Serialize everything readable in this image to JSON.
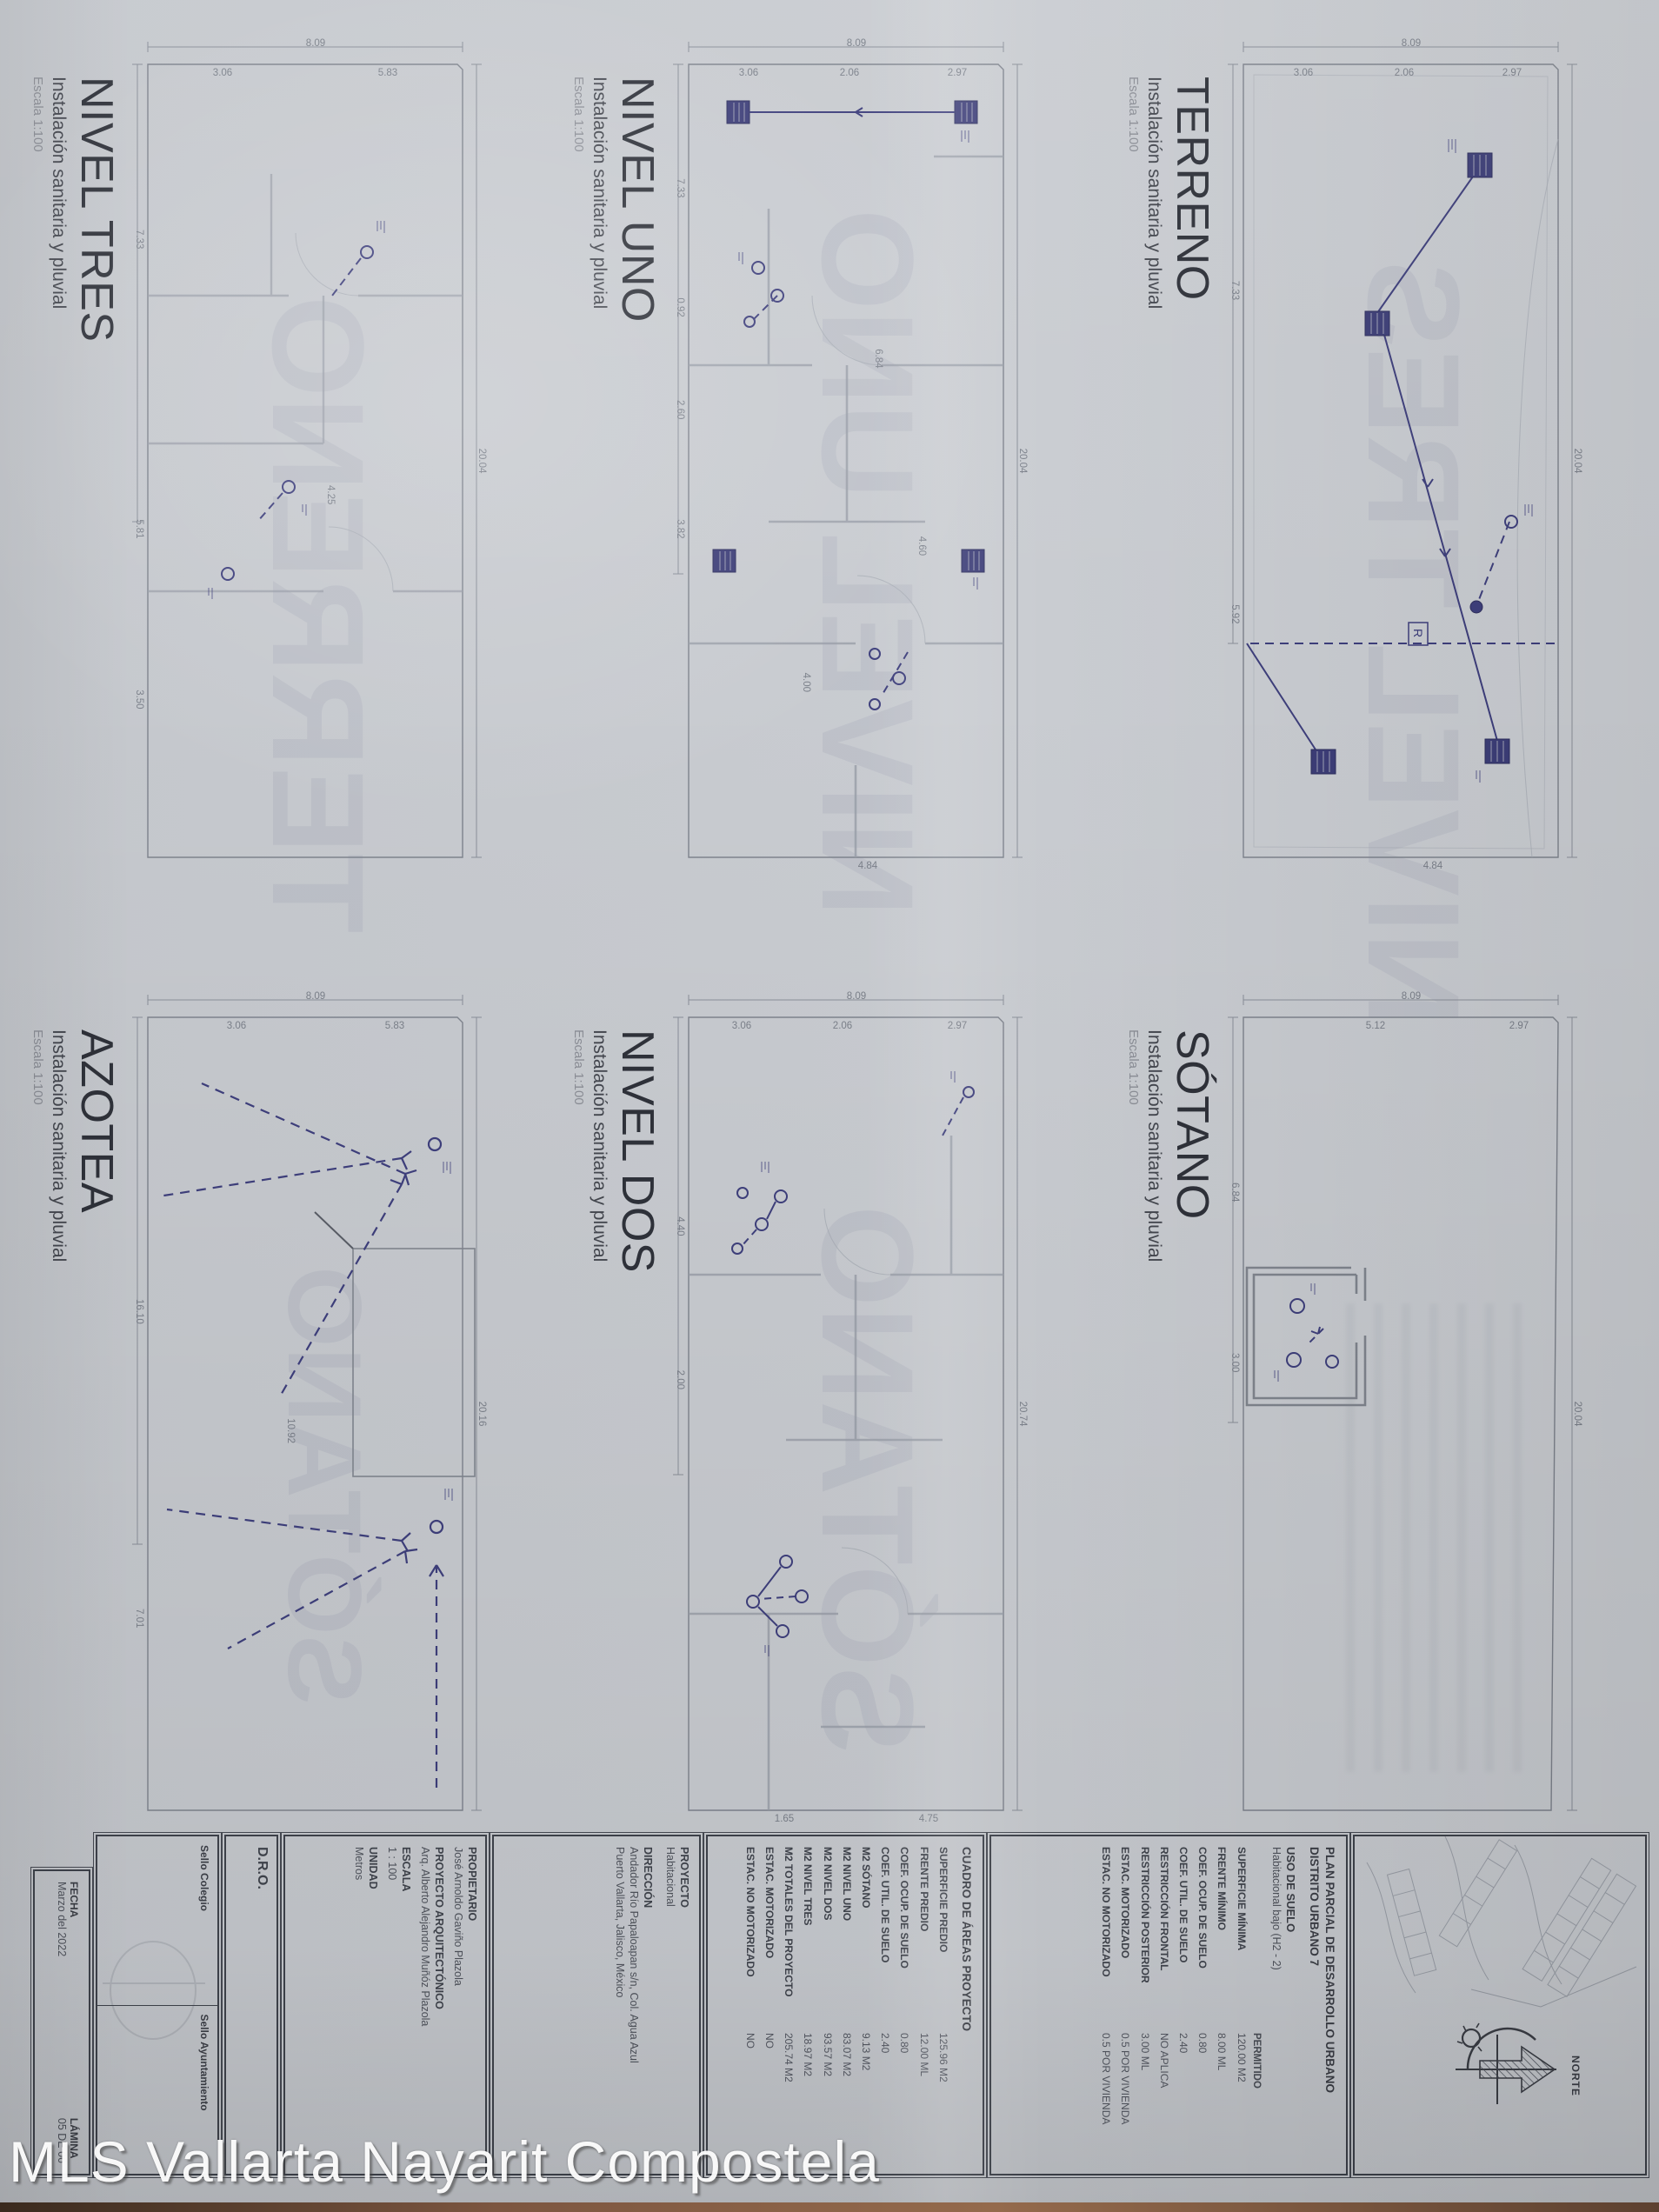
{
  "watermark": {
    "text": "MLS Vallarta Nayarit Compostela"
  },
  "panels": [
    {
      "title": "TERRENO",
      "subtitle": "Instalación sanitaria y pluvial",
      "scale": "Escala 1:100",
      "ghost": "NIVEL TRES",
      "r_label": "R",
      "dims": [
        {
          "t": "8.09",
          "x": 1,
          "y": 48,
          "v": 1
        },
        {
          "t": "2.97",
          "x": 4.5,
          "y": 20,
          "v": 1
        },
        {
          "t": "2.06",
          "x": 4.5,
          "y": 50,
          "v": 1
        },
        {
          "t": "3.06",
          "x": 4.5,
          "y": 78,
          "v": 1
        },
        {
          "t": "20.04",
          "x": 50,
          "y": 2
        },
        {
          "t": "7.33",
          "x": 30,
          "y": 97
        },
        {
          "t": "5.92",
          "x": 68,
          "y": 97
        },
        {
          "t": "4.84",
          "x": 97.5,
          "y": 42,
          "v": 1
        }
      ]
    },
    {
      "title": "NIVEL UNO",
      "subtitle": "Instalación sanitaria y pluvial",
      "scale": "Escala 1:100",
      "ghost": "NIVEL UNO",
      "dims": [
        {
          "t": "8.09",
          "x": 1,
          "y": 48,
          "v": 1
        },
        {
          "t": "2.97",
          "x": 4.5,
          "y": 20,
          "v": 1
        },
        {
          "t": "2.06",
          "x": 4.5,
          "y": 50,
          "v": 1
        },
        {
          "t": "3.06",
          "x": 4.5,
          "y": 78,
          "v": 1
        },
        {
          "t": "20.04",
          "x": 50,
          "y": 2
        },
        {
          "t": "7.33",
          "x": 18,
          "y": 97
        },
        {
          "t": "0.92",
          "x": 32,
          "y": 97
        },
        {
          "t": "2.60",
          "x": 44,
          "y": 97
        },
        {
          "t": "3.82",
          "x": 58,
          "y": 97
        },
        {
          "t": "4.84",
          "x": 97.5,
          "y": 45,
          "v": 1
        },
        {
          "t": "6.84",
          "x": 38,
          "y": 42
        },
        {
          "t": "4.60",
          "x": 60,
          "y": 30
        },
        {
          "t": "4.00",
          "x": 76,
          "y": 62
        }
      ]
    },
    {
      "title": "NIVEL TRES",
      "subtitle": "Instalación sanitaria y pluvial",
      "scale": "Escala 1:100",
      "ghost": "TERRENO",
      "dims": [
        {
          "t": "8.09",
          "x": 1,
          "y": 48,
          "v": 1
        },
        {
          "t": "5.83",
          "x": 4.5,
          "y": 28,
          "v": 1
        },
        {
          "t": "3.06",
          "x": 4.5,
          "y": 74,
          "v": 1
        },
        {
          "t": "20.04",
          "x": 50,
          "y": 2
        },
        {
          "t": "7.33",
          "x": 24,
          "y": 97
        },
        {
          "t": "5.81",
          "x": 58,
          "y": 97
        },
        {
          "t": "3.50",
          "x": 78,
          "y": 97
        },
        {
          "t": "4.25",
          "x": 54,
          "y": 44
        }
      ]
    },
    {
      "title": "SÓTANO",
      "subtitle": "Instalación sanitaria y pluvial",
      "scale": "Escala 1:100",
      "ghost": "",
      "dims": [
        {
          "t": "8.09",
          "x": 1,
          "y": 48,
          "v": 1
        },
        {
          "t": "2.97",
          "x": 4.5,
          "y": 18,
          "v": 1
        },
        {
          "t": "5.12",
          "x": 4.5,
          "y": 58,
          "v": 1
        },
        {
          "t": "20.04",
          "x": 50,
          "y": 2
        },
        {
          "t": "6.84",
          "x": 24,
          "y": 97
        },
        {
          "t": "3.00",
          "x": 44,
          "y": 97
        }
      ]
    },
    {
      "title": "NIVEL DOS",
      "subtitle": "Instalación sanitaria y pluvial",
      "scale": "Escala 1:100",
      "ghost": "SÓTANO",
      "dims": [
        {
          "t": "8.09",
          "x": 1,
          "y": 48,
          "v": 1
        },
        {
          "t": "2.97",
          "x": 4.5,
          "y": 20,
          "v": 1
        },
        {
          "t": "2.06",
          "x": 4.5,
          "y": 52,
          "v": 1
        },
        {
          "t": "3.06",
          "x": 4.5,
          "y": 80,
          "v": 1
        },
        {
          "t": "20.74",
          "x": 50,
          "y": 2
        },
        {
          "t": "4.40",
          "x": 28,
          "y": 97
        },
        {
          "t": "2.00",
          "x": 46,
          "y": 97
        },
        {
          "t": "4.75",
          "x": 97.5,
          "y": 28,
          "v": 1
        },
        {
          "t": "1.65",
          "x": 97.5,
          "y": 68,
          "v": 1
        }
      ]
    },
    {
      "title": "AZOTEA",
      "subtitle": "Instalación sanitaria y pluvial",
      "scale": "Escala 1:100",
      "ghost": "SÓTANO",
      "dims": [
        {
          "t": "8.09",
          "x": 1,
          "y": 48,
          "v": 1
        },
        {
          "t": "5.83",
          "x": 4.5,
          "y": 26,
          "v": 1
        },
        {
          "t": "3.06",
          "x": 4.5,
          "y": 70,
          "v": 1
        },
        {
          "t": "20.16",
          "x": 50,
          "y": 2
        },
        {
          "t": "16.10",
          "x": 38,
          "y": 97
        },
        {
          "t": "7.01",
          "x": 74,
          "y": 97
        },
        {
          "t": "10.92",
          "x": 52,
          "y": 55
        }
      ]
    }
  ],
  "titleblock": {
    "norte_label": "NORTE",
    "plan_parcial": {
      "title_l1": "PLAN PARCIAL DE DESARROLLO URBANO",
      "title_l2": "DISTRITO URBANO 7",
      "uso_header": "USO DE SUELO",
      "uso_value": "Habitacional bajo (H2 - 2)",
      "col_header": "PERMITIDO",
      "rows": [
        [
          "SUPERFICIE MÍNIMA",
          "120.00 M2"
        ],
        [
          "FRENTE MÍNIMO",
          "8.00 ML"
        ],
        [
          "COEF. OCUP. DE SUELO",
          "0.80"
        ],
        [
          "COEF. UTIL. DE SUELO",
          "2.40"
        ],
        [
          "RESTRICCIÓN FRONTAL",
          "NO APLICA"
        ],
        [
          "RESTRICCIÓN POSTERIOR",
          "3.00 ML"
        ],
        [
          "ESTAC. MOTORIZADO",
          "0.5 POR VIVIENDA"
        ],
        [
          "ESTAC. NO MOTORIZADO",
          "0.5 POR VIVIENDA"
        ]
      ]
    },
    "cuadro": {
      "title": "CUADRO DE ÁREAS PROYECTO",
      "rows": [
        [
          "SUPERFICIE PREDIO",
          "125.96 M2"
        ],
        [
          "FRENTE PREDIO",
          "12.00 ML"
        ],
        [
          "COEF. OCUP. DE SUELO",
          "0.80"
        ],
        [
          "COEF. UTIL. DE SUELO",
          "2.40"
        ],
        [
          "M2 SÓTANO",
          "9.13 M2"
        ],
        [
          "M2 NIVEL UNO",
          "83.07 M2"
        ],
        [
          "M2 NIVEL DOS",
          "93.57 M2"
        ],
        [
          "M2 NIVEL TRES",
          "18.97 M2"
        ],
        [
          "M2 TOTALES DEL PROYECTO",
          "205.74 M2"
        ],
        [
          "ESTAC. MOTORIZADO",
          "NO"
        ],
        [
          "ESTAC. NO MOTORIZADO",
          "NO"
        ]
      ]
    },
    "proyecto": {
      "label": "PROYECTO",
      "value": "Habitacional",
      "direccion_label": "DIRECCIÓN",
      "direccion_l1": "Andador Río Papaloapan s/n, Col. Agua Azul",
      "direccion_l2": "Puerto Vallarta, Jalisco, México"
    },
    "arq": {
      "prop_label": "PROPIETARIO",
      "prop_value": "José Arnoldo Gaviño Plazola",
      "label": "PROYECTO ARQUITECTÓNICO",
      "value": "Arq. Alberto Alejandro Muñóz Plazola",
      "escala_label": "ESCALA",
      "escala_value": "1 : 100",
      "unidad_label": "UNIDAD",
      "unidad_value": "Metros"
    },
    "dro_label": "D.R.O.",
    "sellos": {
      "colegio": "Sello Colegio",
      "ayuntamiento": "Sello Ayuntamiento"
    },
    "fecha": {
      "label": "FECHA",
      "value": "Marzo del 2022",
      "lamina_label": "LÁMINA",
      "lamina_value": "05 DE 06"
    }
  }
}
